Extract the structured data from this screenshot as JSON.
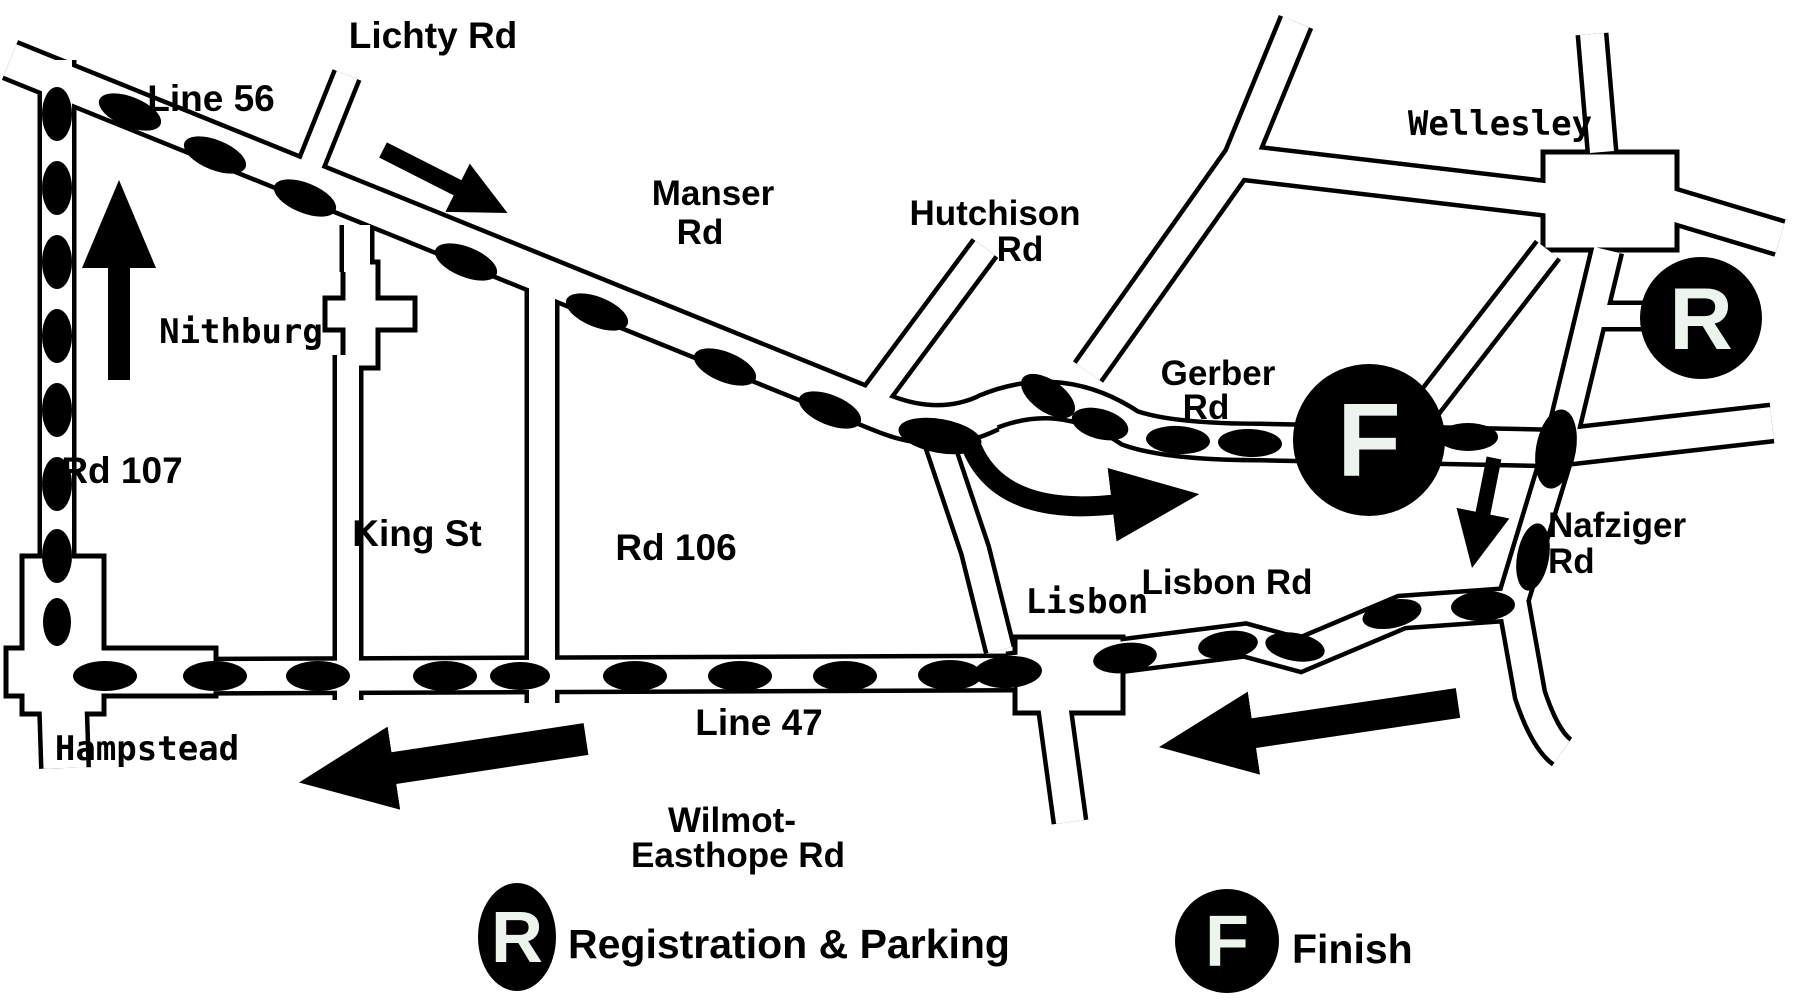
{
  "map": {
    "colors": {
      "background": "#ffffff",
      "road_fill": "#ffffff",
      "road_outline": "#000000",
      "route_marker": "#000000",
      "arrow": "#000000",
      "marker_circle": "#000000",
      "marker_letter": "#edf3ed"
    },
    "road_labels": {
      "line_56": "Line 56",
      "lichty_rd": "Lichty Rd",
      "manser_rd": {
        "lines": [
          "Manser",
          "Rd"
        ]
      },
      "hutchison_rd": {
        "lines": [
          "Hutchison",
          "Rd"
        ]
      },
      "rd_107": "Rd 107",
      "king_st": "King St",
      "rd_106": "Rd 106",
      "gerber_rd": {
        "lines": [
          "Gerber",
          "Rd"
        ]
      },
      "nafziger_rd": {
        "lines": [
          "Nafziger",
          "Rd"
        ]
      },
      "lisbon_rd": "Lisbon Rd",
      "line_47": "Line 47",
      "wilmot_easthope_rd": {
        "lines": [
          "Wilmot-",
          "Easthope Rd"
        ]
      }
    },
    "towns": {
      "nithburg": "Nithburg",
      "wellesley": "Wellesley",
      "hampstead": "Hampstead",
      "lisbon": "Lisbon"
    },
    "markers": {
      "finish_symbol": "F",
      "registration_symbol": "R"
    },
    "legend": {
      "registration_symbol": "R",
      "registration_label": "Registration & Parking",
      "finish_symbol": "F",
      "finish_label": "Finish"
    },
    "route_ovals": [
      {
        "x": 130,
        "y": 112,
        "rx": 33,
        "ry": 15,
        "rot": 22
      },
      {
        "x": 215,
        "y": 155,
        "rx": 33,
        "ry": 15,
        "rot": 22
      },
      {
        "x": 305,
        "y": 198,
        "rx": 33,
        "ry": 15,
        "rot": 22
      },
      {
        "x": 466,
        "y": 262,
        "rx": 33,
        "ry": 15,
        "rot": 22
      },
      {
        "x": 597,
        "y": 312,
        "rx": 33,
        "ry": 15,
        "rot": 22
      },
      {
        "x": 725,
        "y": 367,
        "rx": 33,
        "ry": 15,
        "rot": 22
      },
      {
        "x": 830,
        "y": 410,
        "rx": 33,
        "ry": 15,
        "rot": 22
      },
      {
        "x": 940,
        "y": 436,
        "rx": 42,
        "ry": 17,
        "rot": 10
      },
      {
        "x": 1048,
        "y": 396,
        "rx": 31,
        "ry": 16,
        "rot": 35
      },
      {
        "x": 1100,
        "y": 424,
        "rx": 29,
        "ry": 15,
        "rot": 15
      },
      {
        "x": 1178,
        "y": 440,
        "rx": 32,
        "ry": 14,
        "rot": 3
      },
      {
        "x": 1250,
        "y": 443,
        "rx": 32,
        "ry": 14,
        "rot": 2
      },
      {
        "x": 1468,
        "y": 437,
        "rx": 30,
        "ry": 14,
        "rot": 0
      },
      {
        "x": 1556,
        "y": 449,
        "rx": 40,
        "ry": 20,
        "rot": 100
      },
      {
        "x": 1533,
        "y": 557,
        "rx": 34,
        "ry": 16,
        "rot": 100
      },
      {
        "x": 1483,
        "y": 606,
        "rx": 32,
        "ry": 15,
        "rot": -3
      },
      {
        "x": 1392,
        "y": 614,
        "rx": 30,
        "ry": 14,
        "rot": -12
      },
      {
        "x": 1295,
        "y": 647,
        "rx": 30,
        "ry": 14,
        "rot": 10
      },
      {
        "x": 1228,
        "y": 645,
        "rx": 30,
        "ry": 14,
        "rot": -7
      },
      {
        "x": 1125,
        "y": 658,
        "rx": 32,
        "ry": 15,
        "rot": -7
      },
      {
        "x": 1008,
        "y": 672,
        "rx": 34,
        "ry": 16,
        "rot": -3
      },
      {
        "x": 950,
        "y": 675,
        "rx": 32,
        "ry": 15,
        "rot": 0
      },
      {
        "x": 845,
        "y": 676,
        "rx": 32,
        "ry": 15,
        "rot": 0
      },
      {
        "x": 740,
        "y": 676,
        "rx": 32,
        "ry": 15,
        "rot": 0
      },
      {
        "x": 635,
        "y": 676,
        "rx": 32,
        "ry": 15,
        "rot": 0
      },
      {
        "x": 520,
        "y": 676,
        "rx": 30,
        "ry": 14,
        "rot": 0
      },
      {
        "x": 445,
        "y": 676,
        "rx": 32,
        "ry": 15,
        "rot": 0
      },
      {
        "x": 318,
        "y": 676,
        "rx": 32,
        "ry": 15,
        "rot": 0
      },
      {
        "x": 215,
        "y": 676,
        "rx": 32,
        "ry": 15,
        "rot": 0
      },
      {
        "x": 105,
        "y": 676,
        "rx": 32,
        "ry": 15,
        "rot": 0
      },
      {
        "x": 57,
        "y": 114,
        "rx": 15,
        "ry": 27,
        "rot": 0
      },
      {
        "x": 57,
        "y": 188,
        "rx": 15,
        "ry": 27,
        "rot": 0
      },
      {
        "x": 57,
        "y": 262,
        "rx": 15,
        "ry": 27,
        "rot": 0
      },
      {
        "x": 57,
        "y": 336,
        "rx": 15,
        "ry": 27,
        "rot": 0
      },
      {
        "x": 57,
        "y": 410,
        "rx": 15,
        "ry": 27,
        "rot": 0
      },
      {
        "x": 57,
        "y": 484,
        "rx": 15,
        "ry": 27,
        "rot": 0
      },
      {
        "x": 57,
        "y": 556,
        "rx": 15,
        "ry": 27,
        "rot": 0
      },
      {
        "x": 57,
        "y": 622,
        "rx": 14,
        "ry": 24,
        "rot": 0
      }
    ]
  }
}
